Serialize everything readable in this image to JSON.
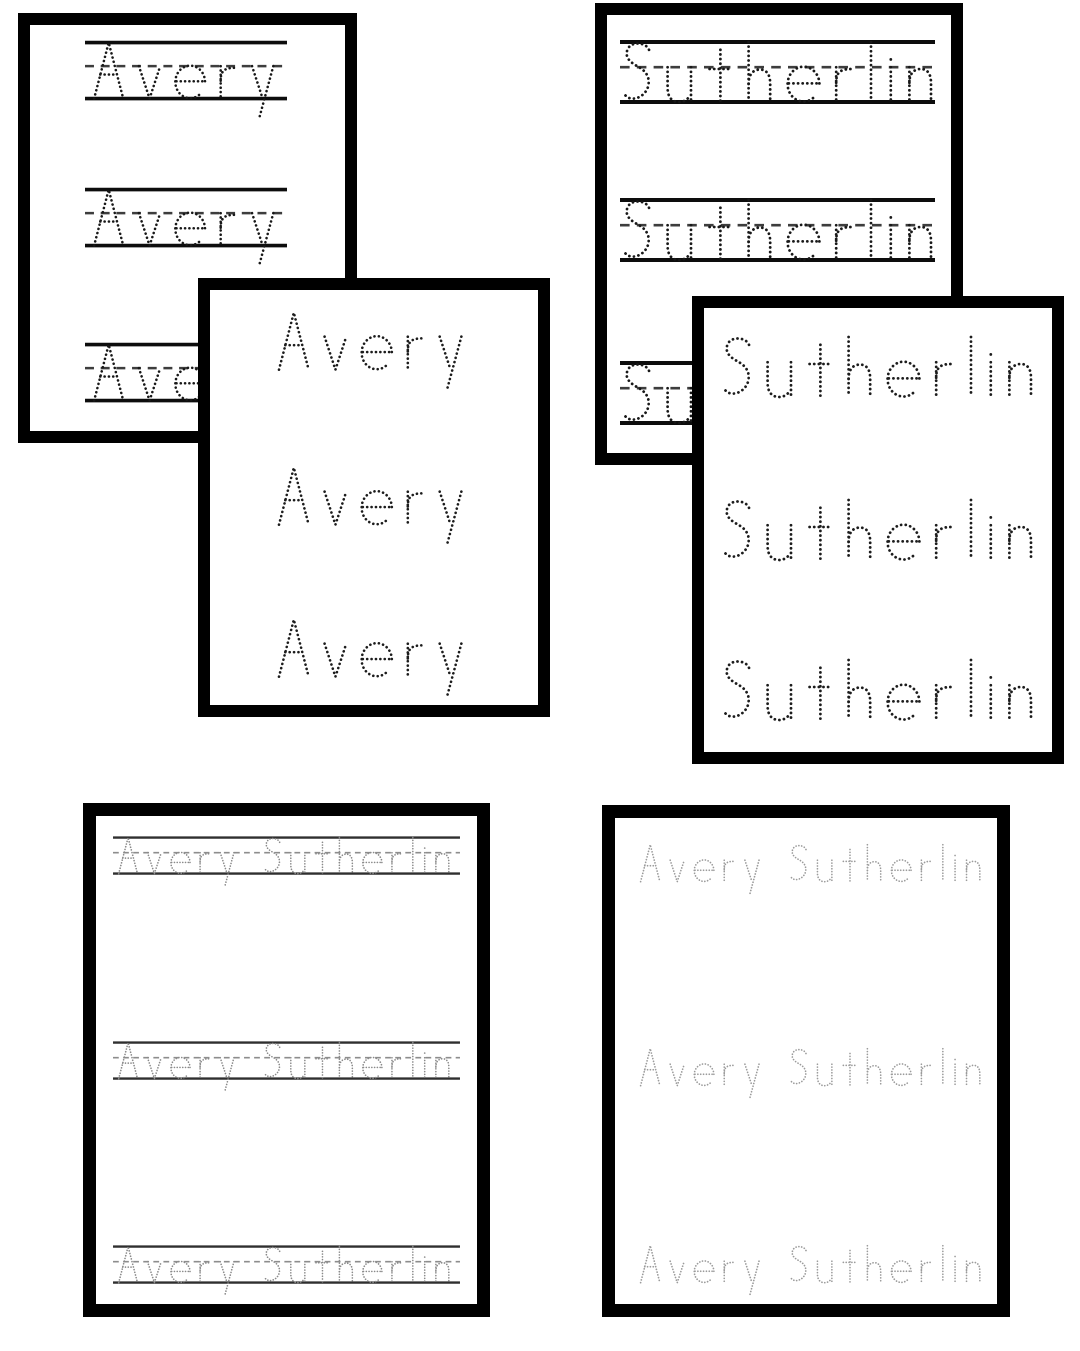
{
  "page": {
    "background": "#ffffff",
    "description": "Six printable name tracing worksheet pages",
    "card_border_color": "#000000"
  },
  "worksheets": [
    {
      "id": "avery-lined",
      "word": "Avery",
      "style": "lined",
      "repetitions": 3,
      "ink": "#181818",
      "guide_solid": "#0d0d0d",
      "guide_dash": "#3d3d3d"
    },
    {
      "id": "sutherlin-lined",
      "word": "Sutherlin",
      "style": "lined",
      "repetitions": 3,
      "ink": "#181818",
      "guide_solid": "#0d0d0d",
      "guide_dash": "#3d3d3d"
    },
    {
      "id": "avery-plain",
      "word": "Avery",
      "style": "plain",
      "repetitions": 3,
      "ink": "#1c1c1c"
    },
    {
      "id": "sutherlin-plain",
      "word": "Sutherlin",
      "style": "plain",
      "repetitions": 3,
      "ink": "#1c1c1c"
    },
    {
      "id": "avery-sutherlin-lined",
      "word": "Avery Sutherlin",
      "style": "lined",
      "repetitions": 3,
      "ink": "#8a8a8a",
      "guide_solid": "#2f2f2f",
      "guide_dash": "#8d8d8d"
    },
    {
      "id": "avery-sutherlin-plain",
      "word": "Avery Sutherlin",
      "style": "plain",
      "repetitions": 3,
      "ink": "#9b9b9b"
    }
  ]
}
